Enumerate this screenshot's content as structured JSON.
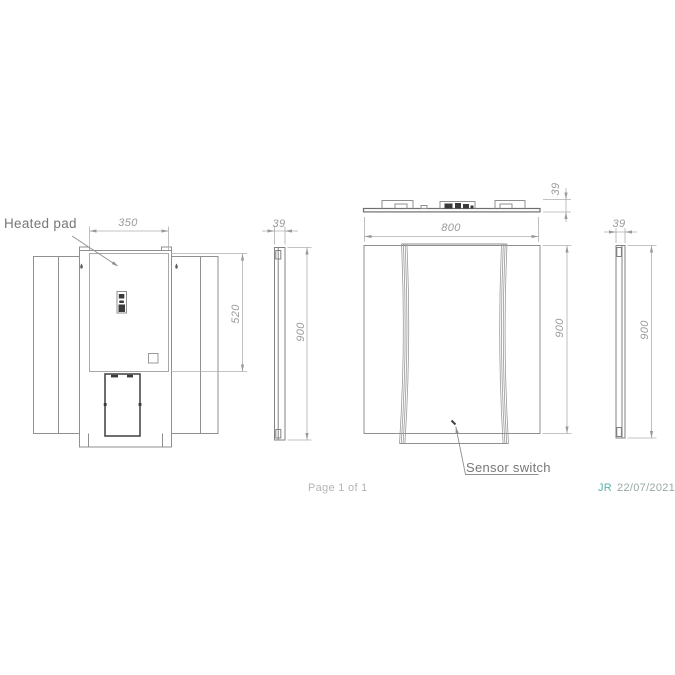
{
  "annotations": {
    "heated_pad": "Heated pad",
    "sensor_switch": "Sensor switch"
  },
  "dimensions": {
    "pad_width_mm": "350",
    "pad_height_mm": "520",
    "mirror_width_mm": "800",
    "mirror_height_mm": "900",
    "mirror_depth_mm": "39"
  },
  "footer": {
    "page_label": "Page 1 of 1",
    "author_initials": "JR",
    "date": "22/07/2021"
  },
  "colors": {
    "outline_gray": "#8f8f8f",
    "pad_gray": "#a8a8a8",
    "dark_detail": "#3a3a3a",
    "dimension_line": "#b0b0b0",
    "dimension_text": "#9a9a9a",
    "label_gray": "#777777",
    "footer_gray": "#b2b6b6",
    "accent_teal": "#58b2a6",
    "background": "#ffffff"
  }
}
